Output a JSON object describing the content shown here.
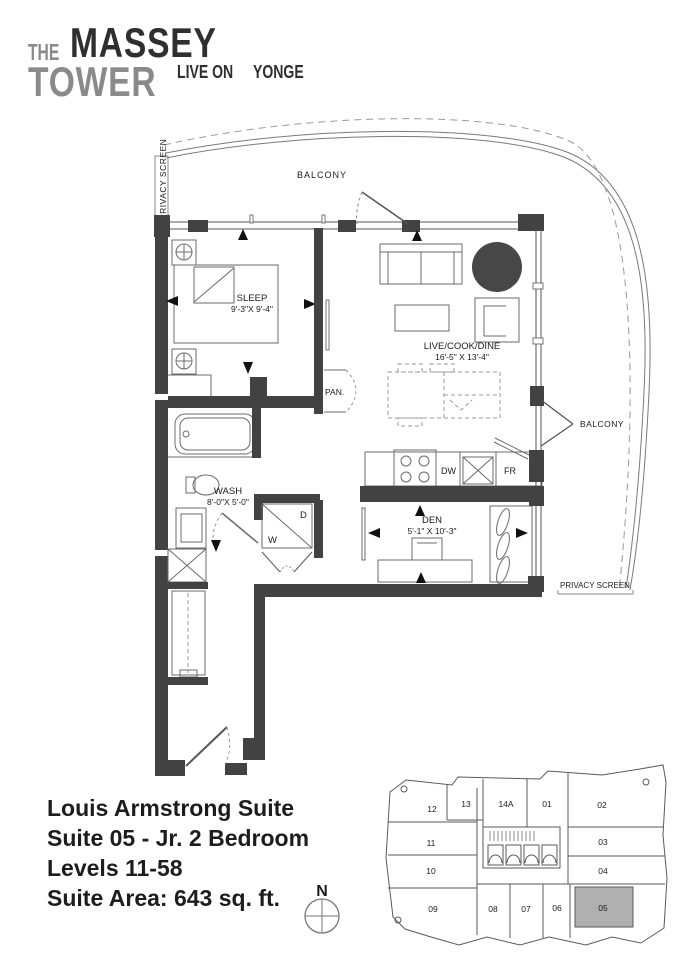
{
  "logo": {
    "the": "THE",
    "massey": "MASSEY",
    "tower": "TOWER",
    "live_on": "LIVE ON",
    "yonge": "YONGE"
  },
  "plan": {
    "labels": {
      "balcony_top": "BALCONY",
      "privacy_screen_left": "PRIVACY SCREEN",
      "sleep": "SLEEP",
      "sleep_dim": "9'-3\"X 9'-4\"",
      "pan": "PAN.",
      "live": "LIVE/COOK/DINE",
      "live_dim": "16'-5\" X 13'-4\"",
      "dw": "DW",
      "fr": "FR",
      "wash": "WASH",
      "wash_dim": "8'-0\"X 5'-0\"",
      "washer": "W",
      "dryer": "D",
      "den": "DEN",
      "den_dim": "5'-1\" X 10'-3\"",
      "balcony_right": "BALCONY",
      "privacy_screen_bottom": "PRIVACY SCREEN"
    }
  },
  "info": {
    "suite_name": "Louis Armstrong Suite",
    "suite_line": "Suite 05 - Jr. 2 Bedroom",
    "levels": "Levels 11-58",
    "area": "Suite Area: 643 sq. ft."
  },
  "compass": {
    "north": "N"
  },
  "keyplan": {
    "highlighted": "05",
    "suites": [
      "12",
      "13",
      "14A",
      "01",
      "02",
      "11",
      "03",
      "10",
      "04",
      "09",
      "08",
      "07",
      "06",
      "05"
    ]
  },
  "colors": {
    "wall": "#424242",
    "rug": "#474747",
    "logo_gray": "#8a8a8a",
    "ink": "#1d1d1d",
    "highlight_suite": "#b0b0b0"
  }
}
